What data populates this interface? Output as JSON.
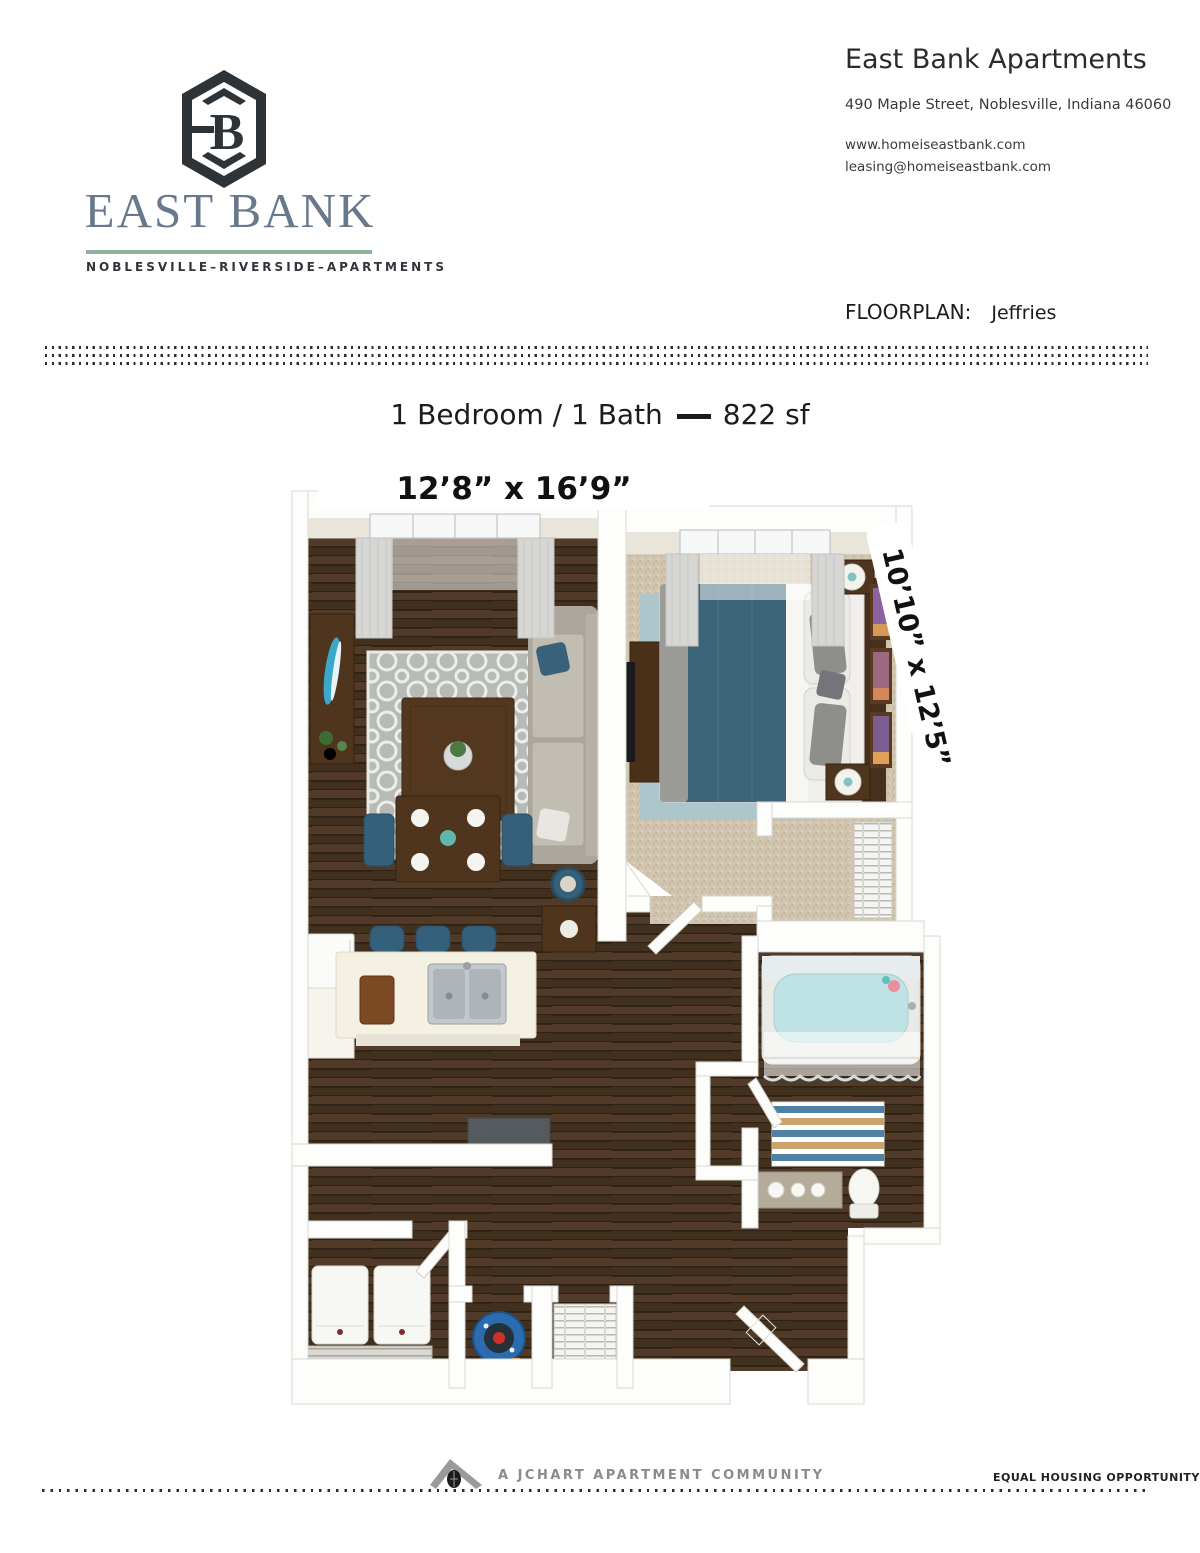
{
  "header": {
    "logo": {
      "mark": "B",
      "wordmark": "EAST BANK",
      "tagline": "NOBLESVILLE–RIVERSIDE–APARTMENTS"
    },
    "contact": {
      "title": "East Bank Apartments",
      "address": "490 Maple Street, Noblesville, Indiana 46060",
      "website": "www.homeiseastbank.com",
      "email": "leasing@homeiseastbank.com"
    },
    "floorplan_label": "FLOORPLAN:",
    "floorplan_name": "Jeffries"
  },
  "unit": {
    "summary": "1 Bedroom / 1 Bath",
    "area": "822 sf"
  },
  "floorplan": {
    "dim_living": "12’8” x 16’9”",
    "dim_bedroom": "10’10” x 12’5”"
  },
  "footer": {
    "community": "A JCHART APARTMENT COMMUNITY",
    "eho": "EQUAL HOUSING OPPORTUNITY"
  },
  "colors": {
    "logo_slate": "#68798b",
    "logo_green": "#8fb09c",
    "logo_dark": "#2e3338",
    "hardwood": "#4a3527",
    "carpet": "#d1c5af",
    "accent_blue": "#35607b",
    "walnut": "#4f341e",
    "bedroom_rug": "#a9c6ce",
    "water_heater_blue": "#2a6cae"
  }
}
